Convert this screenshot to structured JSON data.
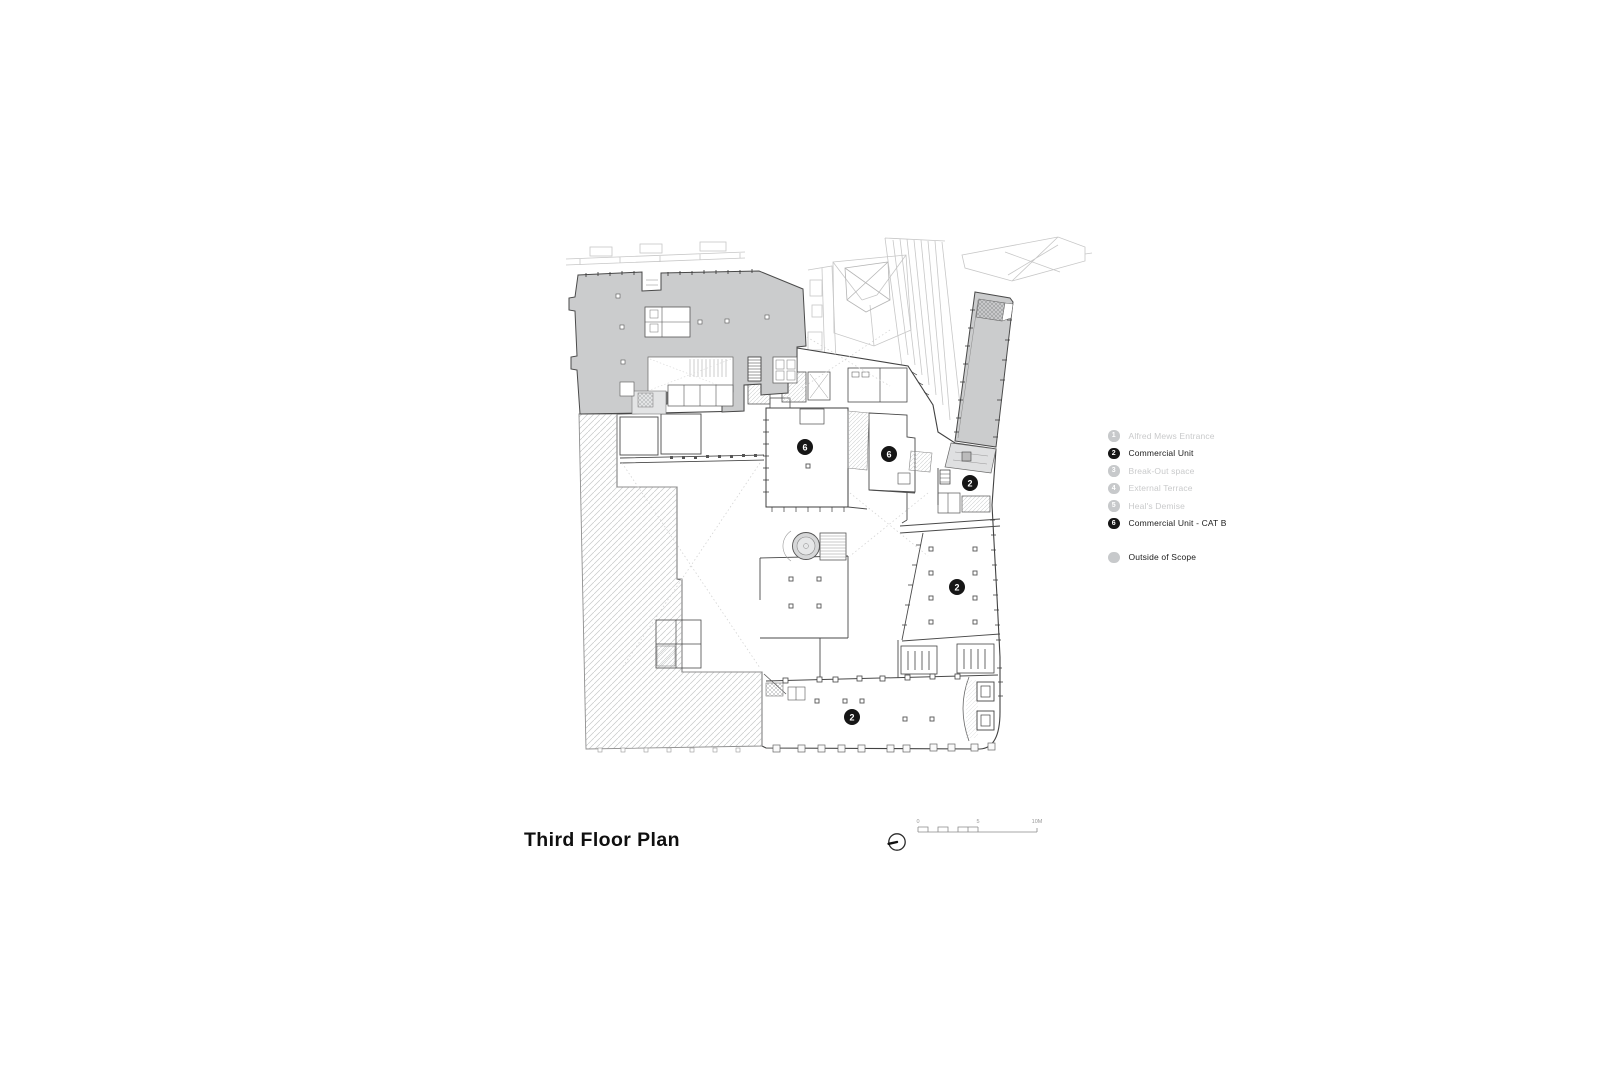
{
  "title": {
    "text": "Third Floor Plan"
  },
  "legend": {
    "items": [
      {
        "num": "1",
        "label": "Alfred Mews Entrance",
        "active": false
      },
      {
        "num": "2",
        "label": "Commercial Unit",
        "active": true
      },
      {
        "num": "3",
        "label": "Break-Out space",
        "active": false
      },
      {
        "num": "4",
        "label": "External Terrace",
        "active": false
      },
      {
        "num": "5",
        "label": "Heal's Demise",
        "active": false
      },
      {
        "num": "6",
        "label": "Commercial Unit - CAT B",
        "active": true
      }
    ],
    "outside": {
      "label": "Outside of Scope"
    }
  },
  "plan": {
    "badges": [
      {
        "num": "6"
      },
      {
        "num": "6"
      },
      {
        "num": "2"
      },
      {
        "num": "2"
      },
      {
        "num": "2"
      }
    ]
  },
  "scale_bar": {
    "zero": "0",
    "mid": "5",
    "end": "10M"
  },
  "colors": {
    "badge_black": "#161616",
    "outside_scope_fill": "#cbcccd",
    "legend_dim": "#c9cacb",
    "text": "#1c1c1c"
  }
}
